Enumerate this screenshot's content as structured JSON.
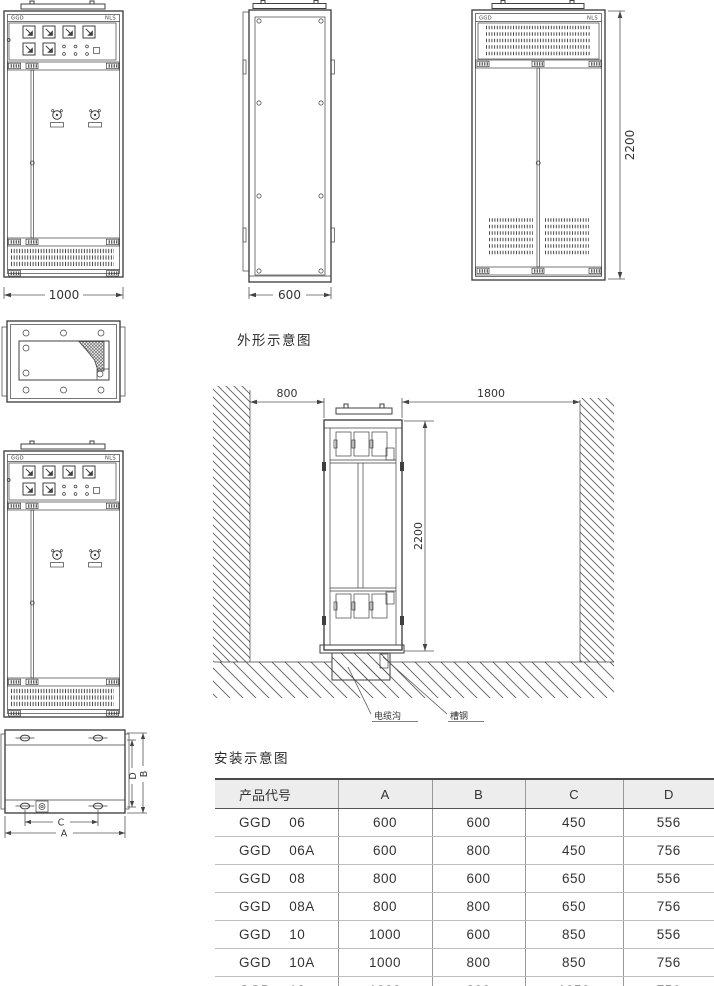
{
  "section_outline": {
    "title": "外形示意图"
  },
  "section_install": {
    "title": "安装示意图"
  },
  "front_view": {
    "label_left": "GGD",
    "label_right": "NLS",
    "width_dim": "1000"
  },
  "side_view": {
    "depth_dim": "600"
  },
  "rear_view": {
    "label_left": "GGD",
    "label_right": "NLS",
    "height_dim": "2200"
  },
  "install": {
    "left_clearance": "800",
    "rear_clearance": "1800",
    "height": "2200",
    "cable_trench_label": "电缆沟",
    "channel_steel_label": "槽钢"
  },
  "plan": {
    "dim_a": "A",
    "dim_b": "B",
    "dim_c": "C",
    "dim_d": "D"
  },
  "table": {
    "headers": [
      "产品代号",
      "A",
      "B",
      "C",
      "D"
    ],
    "rows": [
      {
        "series": "GGD",
        "size": "06",
        "a": "600",
        "b": "600",
        "c": "450",
        "d": "556"
      },
      {
        "series": "GGD",
        "size": "06A",
        "a": "600",
        "b": "800",
        "c": "450",
        "d": "756"
      },
      {
        "series": "GGD",
        "size": "08",
        "a": "800",
        "b": "600",
        "c": "650",
        "d": "556"
      },
      {
        "series": "GGD",
        "size": "08A",
        "a": "800",
        "b": "800",
        "c": "650",
        "d": "756"
      },
      {
        "series": "GGD",
        "size": "10",
        "a": "1000",
        "b": "600",
        "c": "850",
        "d": "556"
      },
      {
        "series": "GGD",
        "size": "10A",
        "a": "1000",
        "b": "800",
        "c": "850",
        "d": "756"
      },
      {
        "series": "GGD",
        "size": "12",
        "a": "1200",
        "b": "800",
        "c": "1050",
        "d": "756"
      }
    ]
  }
}
